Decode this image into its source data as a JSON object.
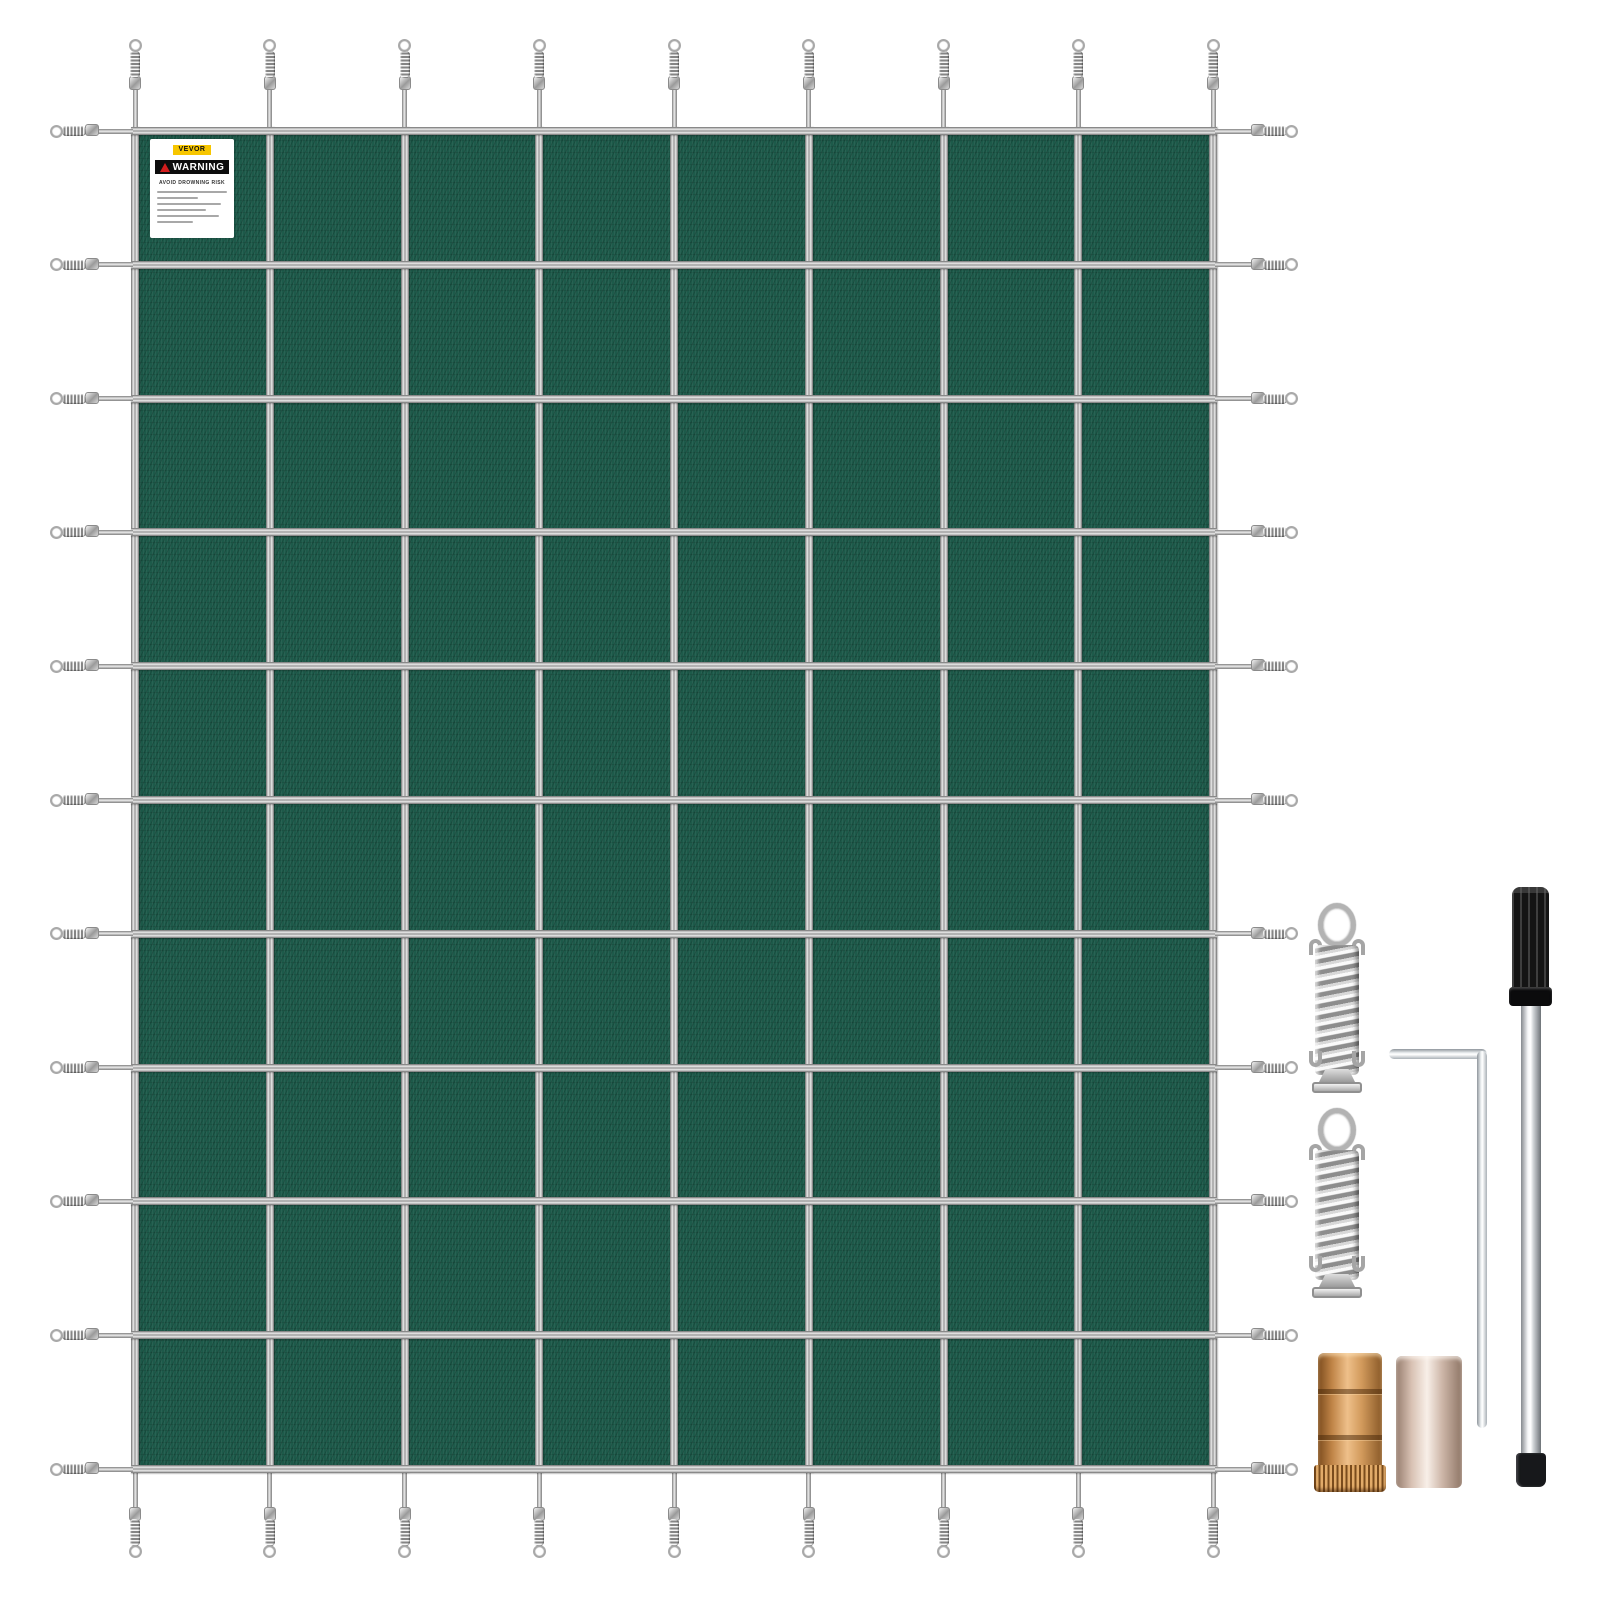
{
  "page": {
    "background": "#ffffff",
    "description_visible_text_only": true
  },
  "label": {
    "brand": "VEVOR",
    "warning_title": "WARNING",
    "warning_subtitle": "AVOID  DROWNING RISK",
    "fine_print_line_count": 6
  },
  "cover": {
    "kind": "rectangular-pool-safety-cover",
    "vertical_straps": 9,
    "horizontal_straps": 11,
    "grid_columns": 8,
    "grid_rows": 10,
    "perimeter_springs": 40
  },
  "accessories": {
    "items": [
      "stainless-tension-spring",
      "stainless-tension-spring",
      "hex-key",
      "installation-rod",
      "brass-anchor",
      "brass-anchor-with-pin"
    ]
  },
  "colors": {
    "fabric": "#1d5a4a",
    "fabric-dark": "#154a3c",
    "strap-hi": "#e8e8e8",
    "strap-mid": "#9c9c9c",
    "strap-dark": "#6e6e6e",
    "metal": "#b8b8b8",
    "brass": "#c88a4e",
    "brass-hi": "#eec08a",
    "brass-dark": "#7c4c1e",
    "nickel": "#dfc9bb",
    "nickel-hi": "#f8efe8",
    "nickel-dark": "#967d6e",
    "rod-handle": "#141414",
    "label-yellow": "#f7c600",
    "warning-red": "#d31d1d",
    "warning-black": "#0d0d0d"
  }
}
